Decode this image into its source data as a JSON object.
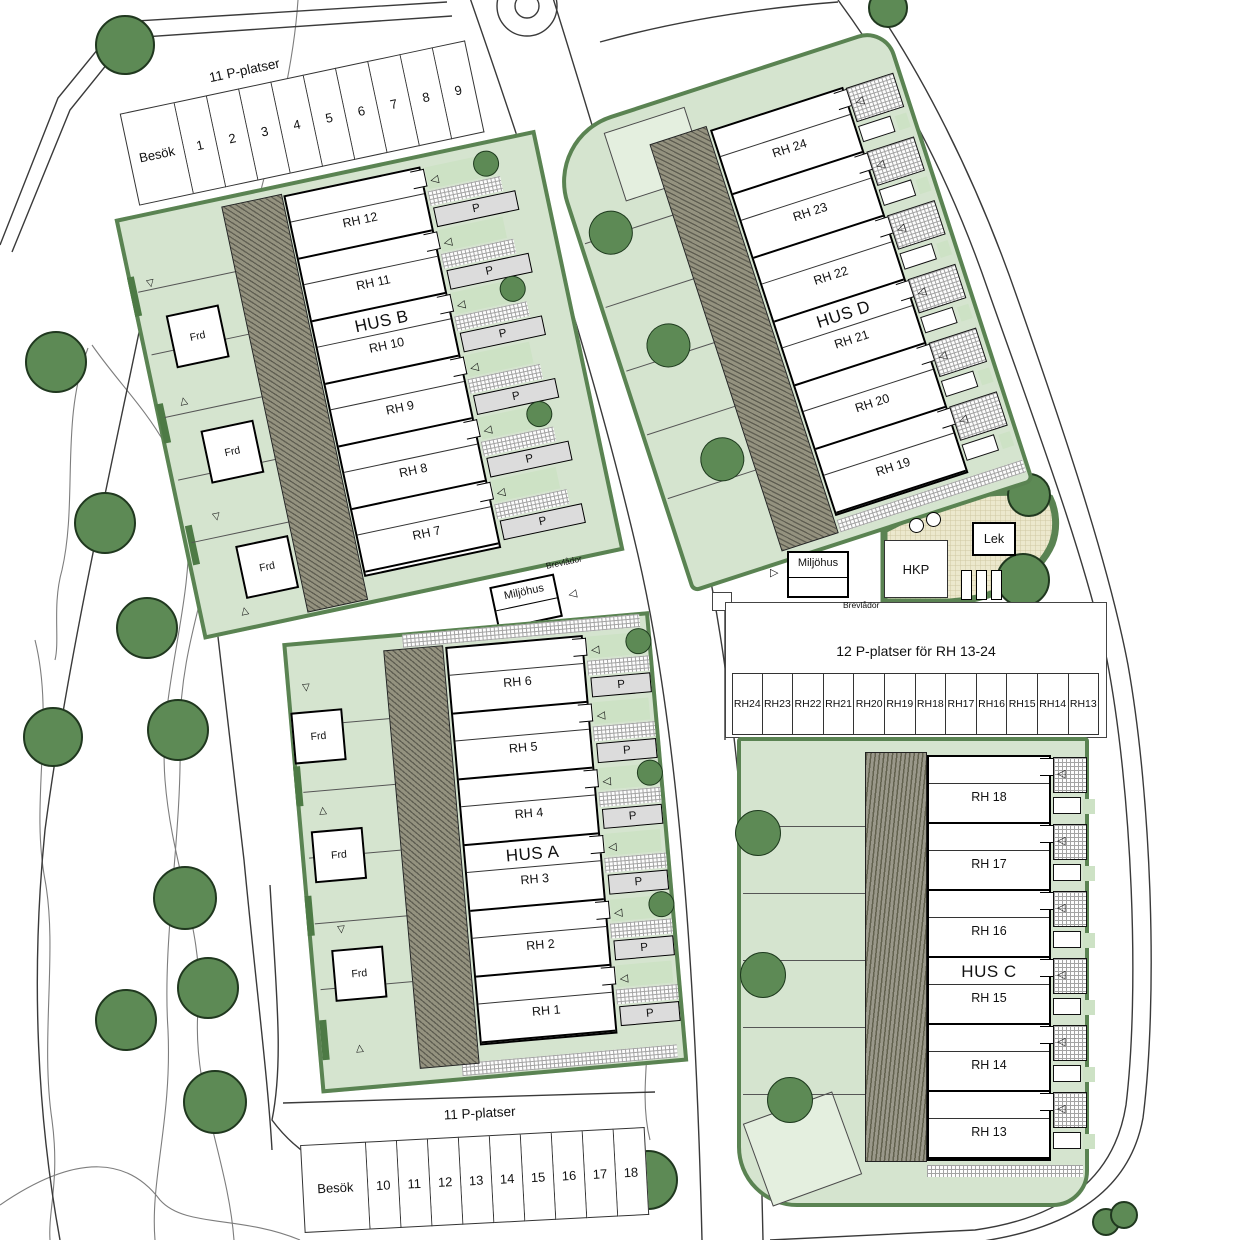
{
  "plan": {
    "buildings": [
      {
        "id": "husB",
        "label": "HUS B",
        "units": [
          "RH 12",
          "RH 11",
          "RH 10",
          "RH 9",
          "RH 8",
          "RH 7"
        ]
      },
      {
        "id": "husA",
        "label": "HUS A",
        "units": [
          "RH 6",
          "RH 5",
          "RH 4",
          "RH 3",
          "RH 2",
          "RH 1"
        ]
      },
      {
        "id": "husD",
        "label": "HUS D",
        "units": [
          "RH 24",
          "RH 23",
          "RH 22",
          "RH 21",
          "RH 20",
          "RH 19"
        ]
      },
      {
        "id": "husC",
        "label": "HUS C",
        "units": [
          "RH 18",
          "RH 17",
          "RH 16",
          "RH 15",
          "RH 14",
          "RH 13"
        ]
      }
    ],
    "parking_nw": {
      "title": "11 P-platser",
      "spaces": [
        "Besök",
        "1",
        "2",
        "3",
        "4",
        "5",
        "6",
        "7",
        "8",
        "9"
      ]
    },
    "parking_s": {
      "title": "11 P-platser",
      "spaces": [
        "Besök",
        "10",
        "11",
        "12",
        "13",
        "14",
        "15",
        "16",
        "17",
        "18"
      ]
    },
    "parking_e": {
      "title": "12 P-platser för RH 13-24",
      "spaces": [
        "RH24",
        "RH23",
        "RH22",
        "RH21",
        "RH20",
        "RH19",
        "RH18",
        "RH17",
        "RH16",
        "RH15",
        "RH14",
        "RH13"
      ]
    },
    "labels": {
      "shed": "Frd",
      "parking_pad": "P",
      "waste_house": "Miljöhus",
      "accessible_parking": "HKP",
      "playground": "Lek",
      "mailboxes": "Brevlådor"
    },
    "colors": {
      "site_green": "#d5e4cf",
      "site_green_light": "#e4efdf",
      "border_green": "#5a8352",
      "tree_green": "#5d8a55",
      "hatch_gray": "#94927f",
      "pad_gray": "#dcdcdc",
      "play_beige": "#ece8cd"
    }
  }
}
